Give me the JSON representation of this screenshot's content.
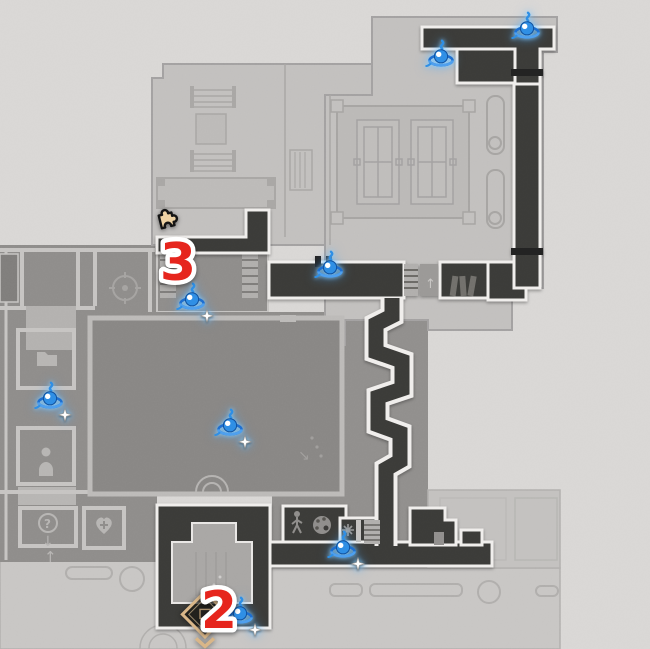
{
  "map": {
    "name": "game-area-map",
    "colors": {
      "background": "#d9d7d5",
      "floor_light": "#c3c1bf",
      "floor_platform": "#bbb9b7",
      "floor_mid": "#8e8c8a",
      "floor_central_room": "#888684",
      "plaza": "#c8c6c4",
      "corridor_dark": "#3b3a38",
      "wall_outline": "#f0eeec",
      "enemy_blue": "#2f8fe5",
      "enemy_glow": "#7ecbff",
      "count_red": "#e6251d",
      "count_outline": "#ffffff",
      "chest_gold": "#d9b688",
      "puzzle_tan": "#eed2a4"
    },
    "markers": {
      "enemies": [
        {
          "id": "enemy-1",
          "icon": "enemy-icon",
          "x": 527,
          "y": 32,
          "sparkle": false
        },
        {
          "id": "enemy-2",
          "icon": "enemy-icon",
          "x": 441,
          "y": 60,
          "sparkle": false
        },
        {
          "id": "enemy-3",
          "icon": "enemy-icon",
          "x": 330,
          "y": 271,
          "sparkle": false
        },
        {
          "id": "enemy-4",
          "icon": "enemy-icon",
          "x": 192,
          "y": 303,
          "sparkle": true
        },
        {
          "id": "enemy-5",
          "icon": "enemy-icon",
          "x": 50,
          "y": 402,
          "sparkle": true
        },
        {
          "id": "enemy-6",
          "icon": "enemy-icon",
          "x": 230,
          "y": 429,
          "sparkle": true
        },
        {
          "id": "enemy-7",
          "icon": "enemy-icon",
          "x": 343,
          "y": 551,
          "sparkle": true
        },
        {
          "id": "enemy-8",
          "icon": "enemy-icon",
          "x": 240,
          "y": 617,
          "sparkle": true
        }
      ],
      "count_labels": [
        {
          "id": "count-3",
          "text": "3",
          "x": 178,
          "y": 263
        },
        {
          "id": "count-2",
          "text": "2",
          "x": 219,
          "y": 611
        }
      ],
      "puzzle": {
        "id": "puzzle-1",
        "icon": "puzzle-piece-icon",
        "x": 166,
        "y": 222
      },
      "chest": {
        "id": "chest-1",
        "icon": "chest-diamond-icon",
        "x": 205,
        "y": 615
      }
    }
  }
}
